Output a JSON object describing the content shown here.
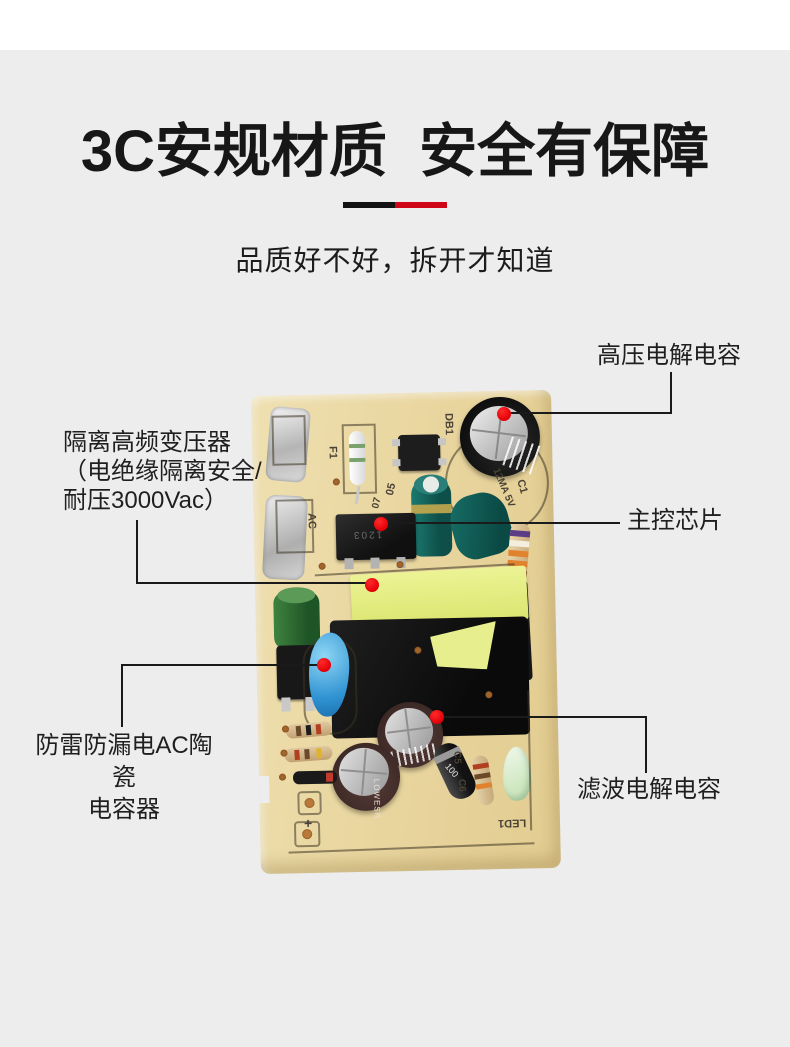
{
  "page": {
    "bg_top": "#ffffff",
    "bg_main": "#ededed"
  },
  "header": {
    "title": "3C安规材质  安全有保障",
    "subtitle": "品质好不好，拆开才知道",
    "divider_black": "#121212",
    "divider_red": "#ce0617"
  },
  "callouts": {
    "hv_cap": {
      "label": "高压电解电容"
    },
    "transformer": {
      "label_line1": "隔离高频变压器",
      "label_line2": "（电绝缘隔离安全/",
      "label_line3": "耐压3000Vac）"
    },
    "main_chip": {
      "label": "主控芯片"
    },
    "ceramic_cap": {
      "label_line1": "防雷防漏电AC陶瓷",
      "label_line2": "电容器"
    },
    "filter_cap": {
      "label": "滤波电解电容"
    },
    "marker_color": "#e30007"
  },
  "pcb": {
    "silkscreen": {
      "f1": "F1",
      "db1": "DB1",
      "ac": "AC",
      "c1": "C1",
      "spec": "12MA 5V",
      "m05": "05",
      "m07": "07",
      "c5": "C5",
      "c6": "C6",
      "led1": "LED1",
      "plus": "+",
      "chip_code": "1203",
      "diode_code": "100",
      "cap_print": "LOWESR"
    },
    "colors": {
      "board": "#e9d6a0",
      "tape_yellow": "#e4ed87",
      "teal_cap": "#15655c",
      "brown_cap": "#4a3230",
      "blue_cap": "#2f92d2"
    }
  }
}
